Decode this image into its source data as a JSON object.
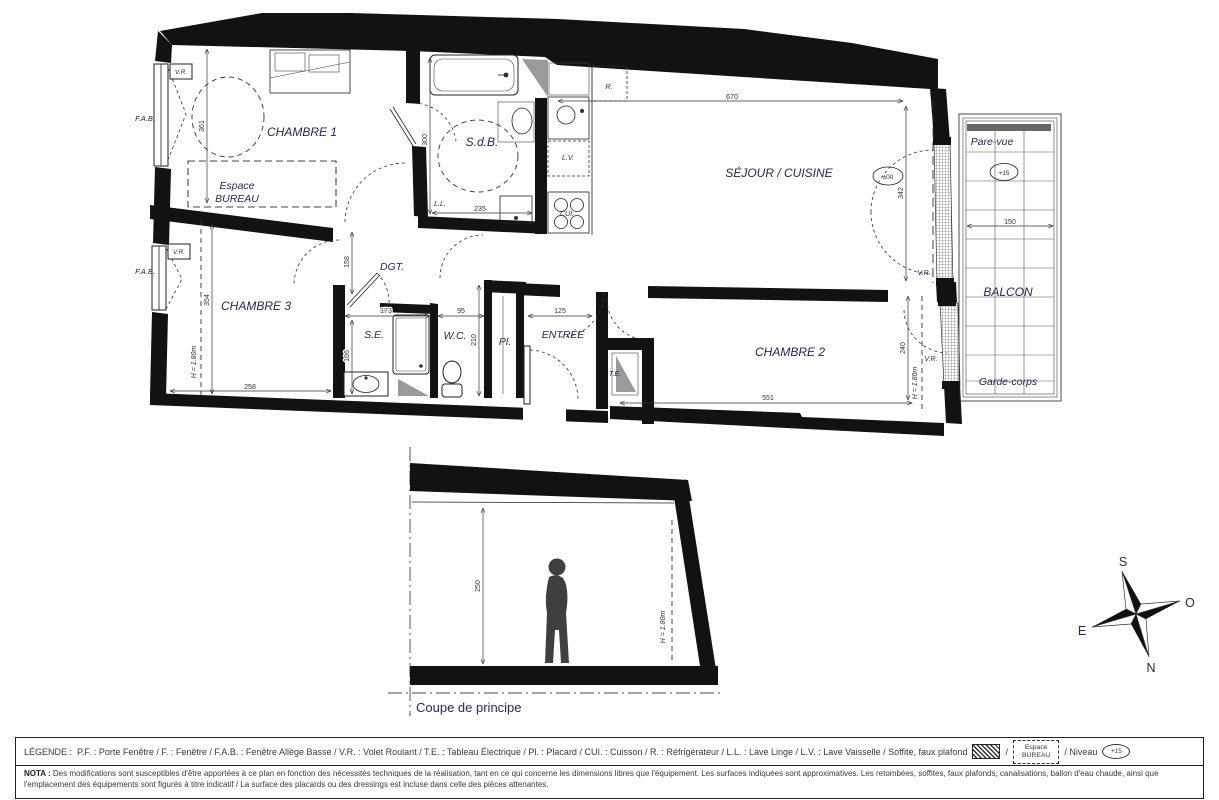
{
  "labels": {
    "chambre1": "CHAMBRE 1",
    "chambre2": "CHAMBRE 2",
    "chambre3": "CHAMBRE 3",
    "sdb": "S.d.B.",
    "sejour": "SÉJOUR / CUISINE",
    "dgt": "DGT.",
    "se": "S.E.",
    "wc": "W.C.",
    "pl": "Pl.",
    "entree": "ENTRÉE",
    "te": "T.E.",
    "ll": "L.L.",
    "lv": "L.V.",
    "cui": "CUI.",
    "r": "R.",
    "vr": "V.R.",
    "fab": "F.A.B.",
    "espace1": "Espace",
    "espace2": "BUREAU",
    "balcon": "BALCON",
    "pare_vue": "Pare-vue",
    "garde_corps": "Garde-corps",
    "h180": "H = 1.80m",
    "niv0": "±00",
    "niv15": "+15"
  },
  "dims": {
    "d670": "670",
    "d342": "342",
    "d361": "361",
    "d300": "300",
    "d235": "235",
    "d158": "158",
    "d173": "173",
    "d95": "95",
    "d210": "210",
    "d125": "125",
    "d166": "166",
    "d354": "354",
    "d258": "258",
    "d551": "551",
    "d240": "240",
    "d150": "150",
    "d250": "250"
  },
  "section": {
    "title": "Coupe de principe"
  },
  "compass": {
    "n": "N",
    "s": "S",
    "e": "E",
    "o": "O"
  },
  "legend": {
    "title": "LÉGENDE :",
    "body": "P.F. : Porte Fenêtre / F. : Fenêtre / F.A.B. : Fenêtre Allège Basse / V.R. : Volet Roulant / T.E. : Tableau Électrique  / Pl. : Placard  / CUI. : Cuisson / R. : Réfrigérateur / L.L. : Lave Linge /  L.V. : Lave Vaisselle / Soffite, faux plafond",
    "sep1": "/",
    "espace1": "Espace",
    "espace2": "BUREAU",
    "niveau": "/  Niveau",
    "badge": "+15"
  },
  "nota": {
    "title": "NOTA :",
    "text": "Des modifications sont susceptibles d'être apportées à ce plan en fonction des nécessités techniques de la réalisation, tant en ce qui concerne les dimensions libres que l'équipement. Les surfaces indiquées sont approximatives. Les retombées, soffites, faux plafonds, canalisations, ballon d'eau chaude, ainsi que l'emplacement des équipements sont figurés à titre indicatif / La surface des placards ou des dressings est incluse dans celle des pièces attenantes."
  }
}
